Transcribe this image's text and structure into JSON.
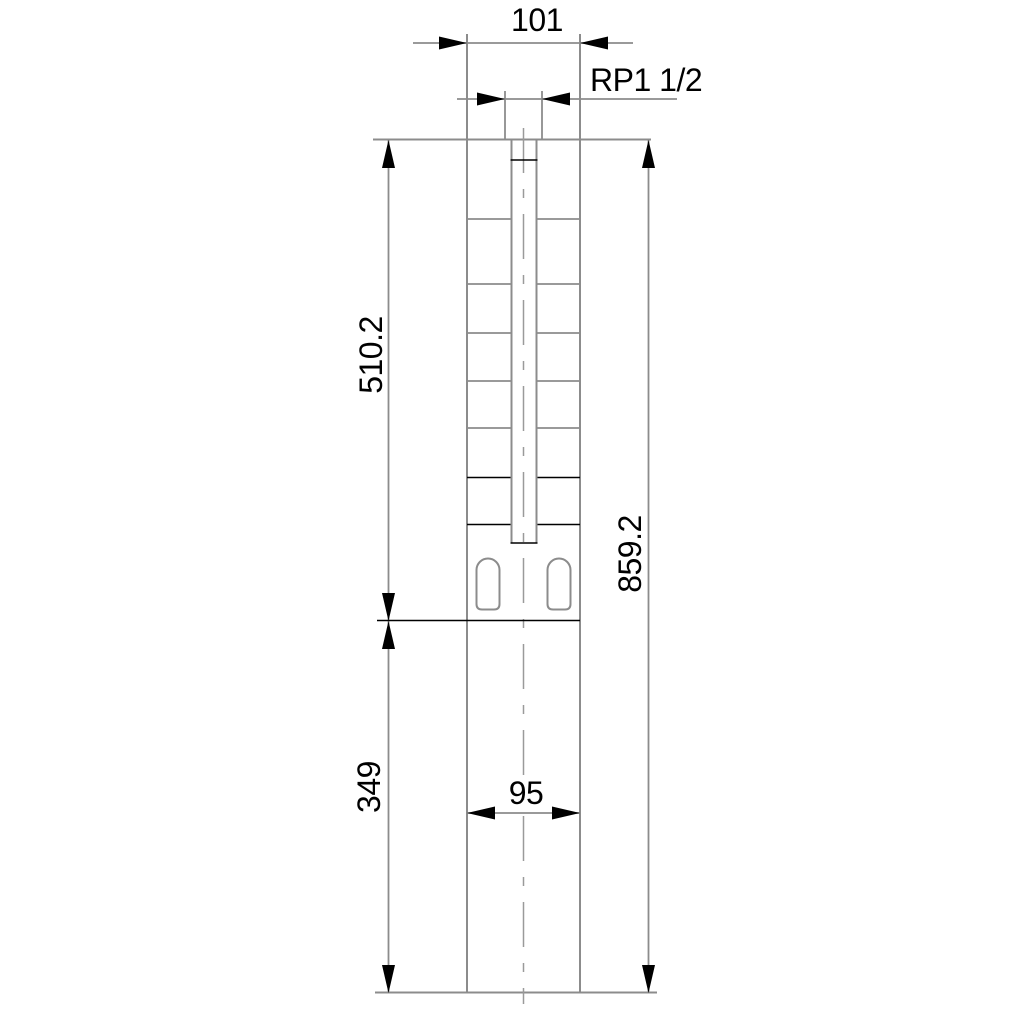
{
  "drawing": {
    "dimensions": {
      "top_width": "101",
      "discharge_thread": "RP1 1/2",
      "pump_section_length": "510.2",
      "overall_length": "859.2",
      "motor_section_length": "349",
      "motor_width": "95"
    },
    "colors": {
      "background": "#ffffff",
      "outline_gray": "#8c8c8c",
      "line_black": "#000000",
      "text": "#000000"
    }
  }
}
